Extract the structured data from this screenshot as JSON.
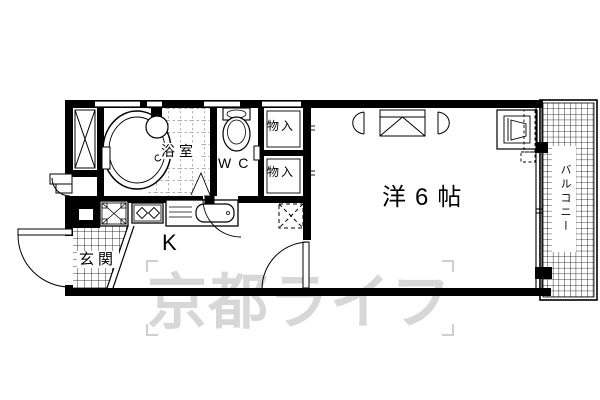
{
  "document": {
    "type": "japanese-apartment-floorplan",
    "background": "#ffffff",
    "line_color": "#000000"
  },
  "rooms": {
    "bathroom": {
      "label": "浴室"
    },
    "toilet": {
      "label": "WC"
    },
    "storage_upper": {
      "label": "物入"
    },
    "storage_lower": {
      "label": "物入"
    },
    "western_room": {
      "label": "洋6帖"
    },
    "kitchen": {
      "label": "K"
    },
    "entrance": {
      "label": "玄関"
    },
    "balcony": {
      "label": "バルコニー"
    }
  },
  "watermark": {
    "text": "京都ライフ",
    "color": "#d7d7d7"
  },
  "fixtures": {
    "bathtub": "bathtub-icon",
    "washbasin": "washbasin-icon",
    "toilet_bowl": "toilet-icon",
    "washing_machine_pan": "washing-machine-pan-icon",
    "gas_stove": "gas-stove-icon",
    "kitchen_sink": "kitchen-sink-icon",
    "refrigerator_space": "refrigerator-space-icon",
    "air_conditioner": "air-conditioner-icon",
    "overhead_cabinet": "overhead-cabinet-icon",
    "meter_box": "meter-box-icon",
    "entrance_step": "entrance-step-icon"
  }
}
